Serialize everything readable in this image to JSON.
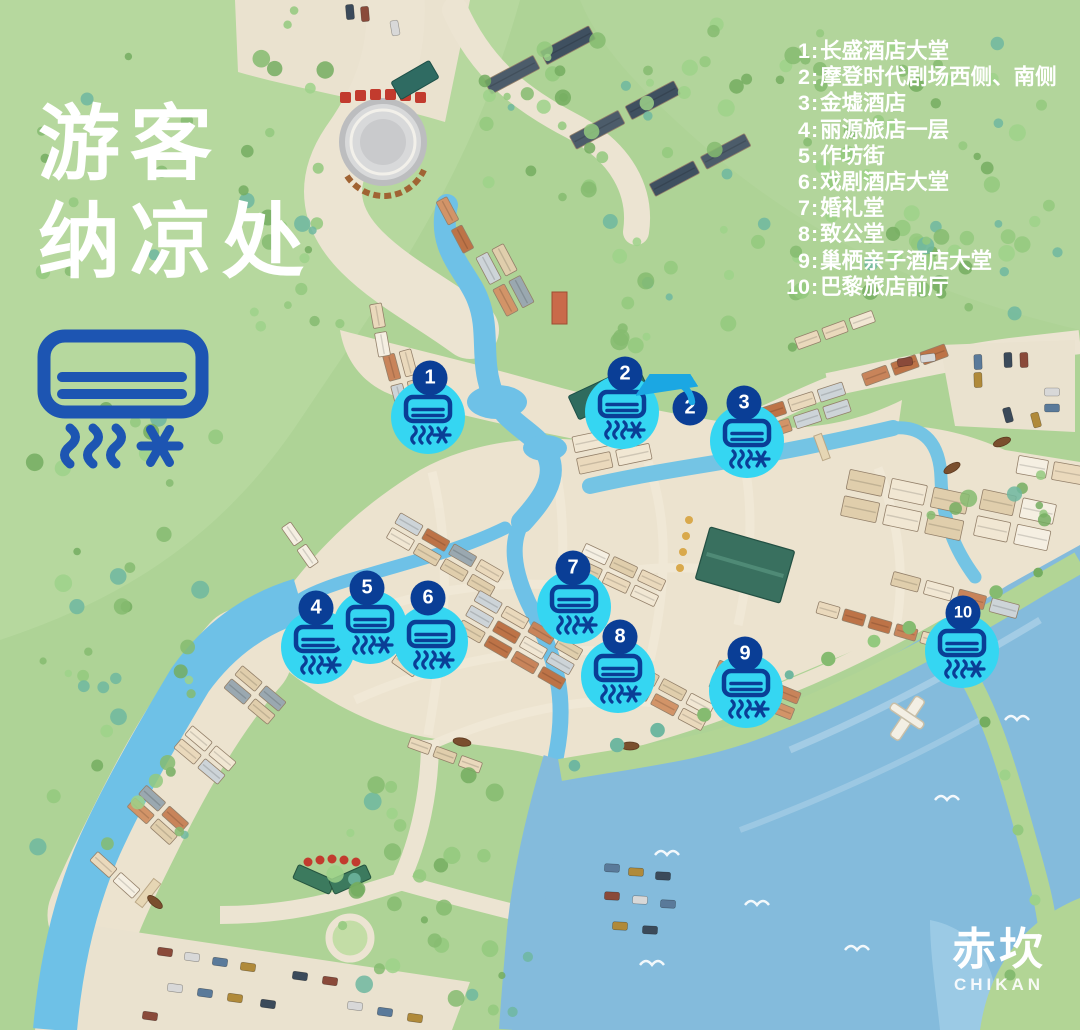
{
  "title": {
    "line1": "游客",
    "line2": "纳凉处"
  },
  "legend": {
    "separator": ":",
    "items": [
      {
        "num": "1",
        "name": "长盛酒店大堂"
      },
      {
        "num": "2",
        "name": "摩登时代剧场西侧、南侧"
      },
      {
        "num": "3",
        "name": "金墟酒店"
      },
      {
        "num": "4",
        "name": "丽源旅店一层"
      },
      {
        "num": "5",
        "name": "作坊街"
      },
      {
        "num": "6",
        "name": "戏剧酒店大堂"
      },
      {
        "num": "7",
        "name": "婚礼堂"
      },
      {
        "num": "8",
        "name": "致公堂"
      },
      {
        "num": "9",
        "name": "巢栖亲子酒店大堂"
      },
      {
        "num": "10",
        "name": "巴黎旅店前厅"
      }
    ]
  },
  "markers": [
    {
      "num": "1",
      "x": 430,
      "y": 378,
      "cx": 428,
      "cy": 417
    },
    {
      "num": "2",
      "x": 625,
      "y": 374,
      "cx": 622,
      "cy": 412,
      "extra_badge": {
        "x": 690,
        "y": 408
      }
    },
    {
      "num": "3",
      "x": 744,
      "y": 403,
      "cx": 747,
      "cy": 441
    },
    {
      "num": "4",
      "x": 316,
      "y": 608,
      "cx": 318,
      "cy": 647
    },
    {
      "num": "5",
      "x": 367,
      "y": 588,
      "cx": 370,
      "cy": 627
    },
    {
      "num": "6",
      "x": 428,
      "y": 598,
      "cx": 431,
      "cy": 642
    },
    {
      "num": "7",
      "x": 573,
      "y": 568,
      "cx": 574,
      "cy": 607
    },
    {
      "num": "8",
      "x": 620,
      "y": 637,
      "cx": 618,
      "cy": 676
    },
    {
      "num": "9",
      "x": 745,
      "y": 654,
      "cx": 746,
      "cy": 691
    },
    {
      "num": "10",
      "x": 963,
      "y": 613,
      "cx": 962,
      "cy": 651
    }
  ],
  "logo": {
    "cn": "赤坎",
    "en": "CHIKAN"
  },
  "colors": {
    "badge_blue": "#0a3e96",
    "marker_cyan": "#35d6f2",
    "icon_blue": "#1d55b2",
    "text_white": "#ffffff"
  },
  "icon_names": [
    "air-conditioner-icon",
    "heat-waves-icon",
    "snowflake-icon"
  ]
}
